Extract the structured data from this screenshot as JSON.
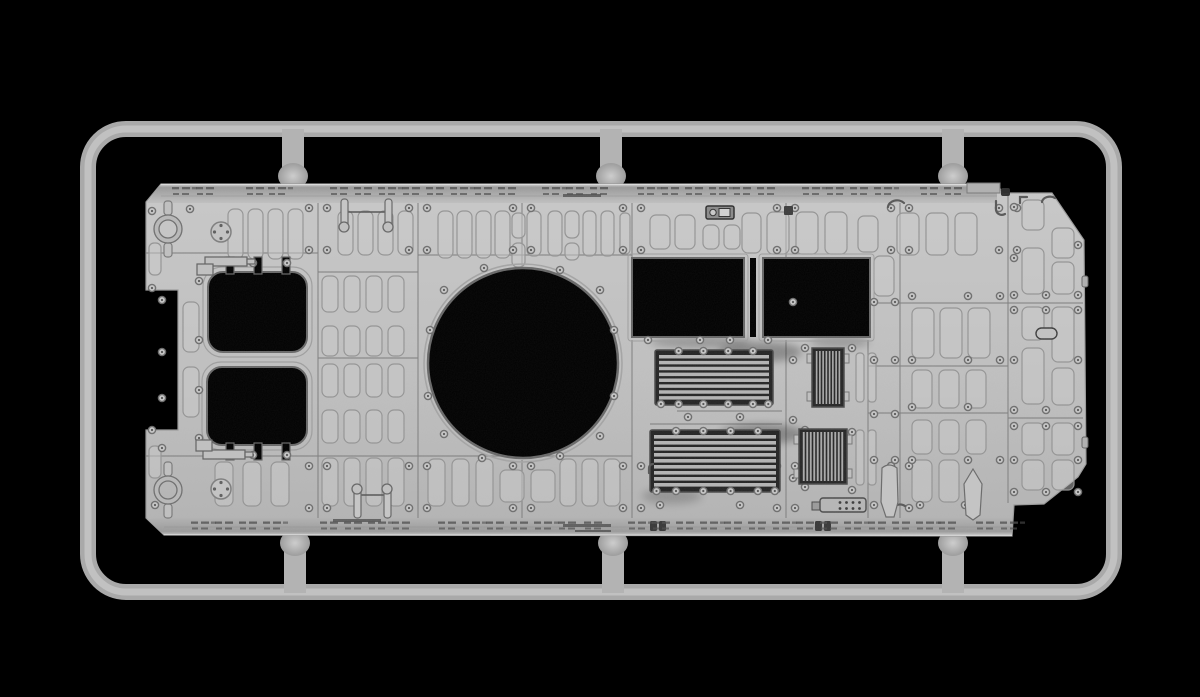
{
  "scene": {
    "description": "3D render of a gray injection-molded model kit sprue: armored vehicle upper hull roof part attached to a rounded rectangular runner frame on a black background",
    "width": 1200,
    "height": 697
  },
  "palette": {
    "background": "#000000",
    "runner": "#a9a9a9",
    "runner_core": "#c1c1c1",
    "gate": "#b3b3b3",
    "face_top": "#c8c8c8",
    "face_mid": "#bfbfbf",
    "face_bottom": "#b2b2b2",
    "strip_dark": "#9a9a9a",
    "strip_light": "#cfcfcf",
    "edge_highlight": "#dcdcdc",
    "outline": "#9a9a9a",
    "panel_line": "#7f7f7f",
    "pad_stroke": "#949494",
    "pad_fill": "#c9c9c9",
    "hole": "#000000",
    "hole_rim": "#686868",
    "rim_light": "#a4a4a4",
    "bolt_ring": "#6e6e6e",
    "bolt_fill": "#c6c6c6",
    "bolt_dot": "#565656",
    "grille_bg": "#242424",
    "grille_slat": "#b3b3b3",
    "detail_fill": "#c0c0c0",
    "detail_stroke": "#606060",
    "tick": "#4f4f4f",
    "dark_fitting": "#383838"
  },
  "sprue": {
    "frame": {
      "x": 88,
      "y": 129,
      "w": 1026,
      "h": 463,
      "rx": 38,
      "thickness": 16
    },
    "gates_top_x": [
      293,
      611,
      953
    ],
    "gates_bottom_x": [
      295,
      613,
      953
    ]
  },
  "part": {
    "outline": "M 161 184 L 997 184 L 1003 193 L 1052 193 L 1084 240 L 1086 464 L 1078 477 L 1044 504 L 1014 505 L 1012 536 L 164 535 L 146 518 L 146 430 L 178 430 L 178 290 L 146 290 L 146 202 Z",
    "strip_top": "M 161 184 L 997 184 L 997 203 L 147 203 Z",
    "strip_bottom": "M 156 518 L 1012 518 L 1012 536 L 164 535 L 147 519 Z",
    "turret_ring": {
      "cx": 523,
      "cy": 363,
      "r": 95
    },
    "hatches": [
      {
        "x": 208,
        "y": 272,
        "w": 99,
        "h": 80,
        "r": 15,
        "notch_side": "top",
        "notch_xs": [
          226,
          254,
          282
        ]
      },
      {
        "x": 207,
        "y": 367,
        "w": 100,
        "h": 78,
        "r": 15,
        "notch_side": "bottom",
        "notch_xs": [
          226,
          254,
          282
        ]
      }
    ],
    "rect_openings": [
      {
        "x": 632,
        "y": 258,
        "w": 112,
        "h": 79
      },
      {
        "x": 763,
        "y": 258,
        "w": 107,
        "h": 79
      }
    ],
    "bridge_slit": {
      "x": 750,
      "y": 258,
      "w": 6,
      "h": 79
    },
    "louver_grilles": [
      {
        "x": 655,
        "y": 350,
        "w": 118,
        "h": 55,
        "slats": 8
      },
      {
        "x": 650,
        "y": 430,
        "w": 130,
        "h": 62,
        "slats": 9
      }
    ],
    "slat_grilles": [
      {
        "x": 812,
        "y": 348,
        "w": 32,
        "h": 59,
        "slats": 8
      },
      {
        "x": 799,
        "y": 429,
        "w": 48,
        "h": 55,
        "slats": 12
      }
    ],
    "panel_lines_v": [
      [
        318,
        203,
        318,
        518
      ],
      [
        418,
        203,
        418,
        518
      ],
      [
        522,
        203,
        522,
        266
      ],
      [
        522,
        460,
        522,
        518
      ],
      [
        632,
        203,
        632,
        258
      ],
      [
        632,
        340,
        632,
        518
      ],
      [
        786,
        203,
        786,
        258
      ],
      [
        786,
        340,
        786,
        518
      ],
      [
        868,
        340,
        868,
        518
      ],
      [
        900,
        203,
        900,
        518
      ],
      [
        1008,
        193,
        1008,
        503
      ]
    ],
    "panel_lines_h": [
      [
        146,
        253,
        318,
        253
      ],
      [
        418,
        255,
        632,
        255
      ],
      [
        318,
        272,
        418,
        272
      ],
      [
        318,
        358,
        418,
        358
      ],
      [
        146,
        456,
        632,
        456
      ],
      [
        868,
        303,
        1083,
        303
      ],
      [
        868,
        366,
        1008,
        366
      ],
      [
        868,
        413,
        1008,
        413
      ],
      [
        1008,
        418,
        1083,
        418
      ],
      [
        677,
        411,
        782,
        411
      ],
      [
        650,
        424,
        782,
        424
      ]
    ],
    "pads": [
      {
        "x": 228,
        "y": 209,
        "w": 15,
        "h": 50,
        "n": 4,
        "g": 5
      },
      {
        "x": 149,
        "y": 243,
        "w": 12,
        "h": 32,
        "n": 1,
        "g": 0
      },
      {
        "x": 338,
        "y": 211,
        "w": 15,
        "h": 44,
        "n": 4,
        "g": 5
      },
      {
        "x": 438,
        "y": 211,
        "w": 15,
        "h": 47,
        "n": 4,
        "g": 4
      },
      {
        "x": 512,
        "y": 213,
        "w": 13,
        "h": 25,
        "n": 1,
        "g": 0
      },
      {
        "x": 512,
        "y": 243,
        "w": 13,
        "h": 24,
        "n": 1,
        "g": 0
      },
      {
        "x": 527,
        "y": 211,
        "w": 14,
        "h": 45,
        "n": 2,
        "g": 7
      },
      {
        "x": 565,
        "y": 211,
        "w": 14,
        "h": 27,
        "n": 1,
        "g": 0
      },
      {
        "x": 565,
        "y": 243,
        "w": 14,
        "h": 17,
        "n": 1,
        "g": 0
      },
      {
        "x": 583,
        "y": 211,
        "w": 13,
        "h": 45,
        "n": 2,
        "g": 5
      },
      {
        "x": 620,
        "y": 213,
        "w": 10,
        "h": 41,
        "n": 1,
        "g": 0
      },
      {
        "x": 650,
        "y": 215,
        "w": 20,
        "h": 34,
        "n": 2,
        "g": 5
      },
      {
        "x": 703,
        "y": 225,
        "w": 16,
        "h": 24,
        "n": 2,
        "g": 5
      },
      {
        "x": 742,
        "y": 213,
        "w": 19,
        "h": 40,
        "n": 1,
        "g": 0
      },
      {
        "x": 767,
        "y": 212,
        "w": 22,
        "h": 42,
        "n": 3,
        "g": 7
      },
      {
        "x": 858,
        "y": 216,
        "w": 20,
        "h": 36,
        "n": 1,
        "g": 0
      },
      {
        "x": 897,
        "y": 213,
        "w": 22,
        "h": 42,
        "n": 3,
        "g": 7
      },
      {
        "x": 322,
        "y": 276,
        "w": 16,
        "h": 36,
        "n": 4,
        "g": 6
      },
      {
        "x": 322,
        "y": 326,
        "w": 16,
        "h": 30,
        "n": 4,
        "g": 6
      },
      {
        "x": 322,
        "y": 364,
        "w": 16,
        "h": 33,
        "n": 4,
        "g": 6
      },
      {
        "x": 322,
        "y": 410,
        "w": 16,
        "h": 33,
        "n": 4,
        "g": 6
      },
      {
        "x": 322,
        "y": 458,
        "w": 16,
        "h": 48,
        "n": 4,
        "g": 6
      },
      {
        "x": 183,
        "y": 302,
        "w": 16,
        "h": 50,
        "n": 1,
        "g": 0
      },
      {
        "x": 183,
        "y": 367,
        "w": 16,
        "h": 50,
        "n": 1,
        "g": 0
      },
      {
        "x": 149,
        "y": 446,
        "w": 12,
        "h": 32,
        "n": 1,
        "g": 0
      },
      {
        "x": 215,
        "y": 462,
        "w": 18,
        "h": 44,
        "n": 3,
        "g": 10
      },
      {
        "x": 428,
        "y": 459,
        "w": 17,
        "h": 47,
        "n": 3,
        "g": 7
      },
      {
        "x": 500,
        "y": 470,
        "w": 24,
        "h": 32,
        "n": 2,
        "g": 7
      },
      {
        "x": 560,
        "y": 459,
        "w": 16,
        "h": 47,
        "n": 3,
        "g": 6
      },
      {
        "x": 856,
        "y": 353,
        "w": 8,
        "h": 49,
        "n": 2,
        "g": 4
      },
      {
        "x": 856,
        "y": 430,
        "w": 8,
        "h": 55,
        "n": 2,
        "g": 4
      },
      {
        "x": 912,
        "y": 308,
        "w": 22,
        "h": 50,
        "n": 3,
        "g": 6
      },
      {
        "x": 912,
        "y": 370,
        "w": 20,
        "h": 38,
        "n": 3,
        "g": 7
      },
      {
        "x": 912,
        "y": 420,
        "w": 20,
        "h": 34,
        "n": 3,
        "g": 7
      },
      {
        "x": 912,
        "y": 460,
        "w": 20,
        "h": 42,
        "n": 2,
        "g": 7
      },
      {
        "x": 874,
        "y": 256,
        "w": 20,
        "h": 40,
        "n": 1,
        "g": 0
      },
      {
        "x": 1022,
        "y": 200,
        "w": 22,
        "h": 30,
        "n": 1,
        "g": 0
      },
      {
        "x": 1022,
        "y": 248,
        "w": 22,
        "h": 46,
        "n": 1,
        "g": 0
      },
      {
        "x": 1052,
        "y": 228,
        "w": 22,
        "h": 30,
        "n": 1,
        "g": 0
      },
      {
        "x": 1052,
        "y": 262,
        "w": 22,
        "h": 32,
        "n": 1,
        "g": 0
      },
      {
        "x": 1022,
        "y": 307,
        "w": 22,
        "h": 33,
        "n": 1,
        "g": 0
      },
      {
        "x": 1052,
        "y": 307,
        "w": 22,
        "h": 55,
        "n": 1,
        "g": 0
      },
      {
        "x": 1022,
        "y": 348,
        "w": 22,
        "h": 56,
        "n": 1,
        "g": 0
      },
      {
        "x": 1052,
        "y": 368,
        "w": 22,
        "h": 37,
        "n": 1,
        "g": 0
      },
      {
        "x": 1022,
        "y": 423,
        "w": 22,
        "h": 32,
        "n": 2,
        "g": 8
      },
      {
        "x": 1022,
        "y": 460,
        "w": 22,
        "h": 30,
        "n": 2,
        "g": 8
      }
    ],
    "bolt_flank_vlines_top": [
      318,
      418,
      522,
      632,
      786,
      900,
      1008
    ],
    "bolt_flank_ys_top": [
      208,
      250
    ],
    "bolt_flank_vlines_bottom": [
      318,
      418,
      522,
      632,
      786,
      900
    ],
    "bolt_flank_ys_bottom": [
      466,
      508
    ],
    "bolts_extra": [
      [
        152,
        211
      ],
      [
        190,
        209
      ],
      [
        152,
        288
      ],
      [
        162,
        300
      ],
      [
        162,
        352
      ],
      [
        162,
        398
      ],
      [
        152,
        430
      ],
      [
        162,
        448
      ],
      [
        155,
        505
      ],
      [
        199,
        281
      ],
      [
        199,
        340
      ],
      [
        199,
        390
      ],
      [
        199,
        438
      ],
      [
        253,
        263
      ],
      [
        287,
        263
      ],
      [
        253,
        455
      ],
      [
        287,
        455
      ],
      [
        600,
        290
      ],
      [
        560,
        270
      ],
      [
        484,
        268
      ],
      [
        444,
        290
      ],
      [
        430,
        330
      ],
      [
        428,
        396
      ],
      [
        444,
        434
      ],
      [
        482,
        458
      ],
      [
        560,
        456
      ],
      [
        600,
        436
      ],
      [
        614,
        330
      ],
      [
        614,
        396
      ],
      [
        688,
        417
      ],
      [
        740,
        417
      ],
      [
        793,
        302
      ],
      [
        793,
        360
      ],
      [
        793,
        420
      ],
      [
        793,
        478
      ],
      [
        805,
        348
      ],
      [
        805,
        430
      ],
      [
        805,
        487
      ],
      [
        852,
        348
      ],
      [
        852,
        432
      ],
      [
        852,
        490
      ],
      [
        874,
        302
      ],
      [
        895,
        302
      ],
      [
        874,
        360
      ],
      [
        895,
        360
      ],
      [
        874,
        414
      ],
      [
        895,
        414
      ],
      [
        874,
        460
      ],
      [
        895,
        460
      ],
      [
        874,
        505
      ],
      [
        912,
        296
      ],
      [
        968,
        296
      ],
      [
        1000,
        296
      ],
      [
        912,
        360
      ],
      [
        968,
        360
      ],
      [
        1000,
        360
      ],
      [
        912,
        407
      ],
      [
        968,
        407
      ],
      [
        912,
        460
      ],
      [
        968,
        460
      ],
      [
        1000,
        460
      ],
      [
        920,
        505
      ],
      [
        965,
        505
      ],
      [
        1014,
        207
      ],
      [
        1014,
        258
      ],
      [
        1078,
        245
      ],
      [
        1014,
        295
      ],
      [
        1046,
        295
      ],
      [
        1078,
        295
      ],
      [
        1014,
        310
      ],
      [
        1046,
        310
      ],
      [
        1078,
        310
      ],
      [
        1014,
        360
      ],
      [
        1078,
        360
      ],
      [
        1014,
        410
      ],
      [
        1046,
        410
      ],
      [
        1078,
        410
      ],
      [
        1014,
        426
      ],
      [
        1046,
        426
      ],
      [
        1078,
        426
      ],
      [
        1014,
        460
      ],
      [
        1078,
        460
      ],
      [
        1014,
        492
      ],
      [
        1046,
        492
      ],
      [
        1078,
        492
      ],
      [
        660,
        505
      ],
      [
        740,
        505
      ],
      [
        648,
        340
      ],
      [
        700,
        340
      ],
      [
        730,
        340
      ],
      [
        768,
        340
      ]
    ],
    "tow_rings": [
      {
        "cx": 168,
        "cy": 229
      },
      {
        "cx": 168,
        "cy": 490
      }
    ],
    "caps": [
      {
        "cx": 221,
        "cy": 232
      },
      {
        "cx": 221,
        "cy": 489
      }
    ],
    "periscope_brackets": [
      [
        [
          205,
          257,
          42,
          9
        ],
        [
          197,
          264,
          16,
          11
        ],
        [
          247,
          259,
          8,
          5
        ]
      ],
      [
        [
          203,
          450,
          42,
          9
        ],
        [
          196,
          440,
          16,
          11
        ],
        [
          245,
          452,
          8,
          5
        ]
      ]
    ],
    "hinge_brackets": [
      {
        "rods": [
          [
            341,
            199,
            7,
            32
          ],
          [
            385,
            199,
            7,
            32
          ]
        ],
        "balls": [
          [
            344,
            227
          ],
          [
            388,
            227
          ]
        ],
        "bar": [
          344,
          212,
          388,
          212
        ]
      },
      {
        "rods": [
          [
            354,
            486,
            7,
            32
          ],
          [
            384,
            486,
            7,
            32
          ]
        ],
        "balls": [
          [
            357,
            489
          ],
          [
            387,
            489
          ]
        ],
        "bar": [
          357,
          495,
          387,
          495
        ]
      }
    ],
    "hooks": [
      "M888 207 a9 7 0 0 1 16 -4",
      "M996 201 l0 9 a6 6 0 0 0 9 4",
      "M1020 203 l0 -6 l7 0",
      "M1042 202 a8 6 0 0 1 13 -4",
      "M649 473 l0 -5 a4 4 0 0 1 4 -4",
      "M893 509 a7 5 0 0 1 12 -3"
    ],
    "raised_block": [
      967,
      183,
      33,
      10
    ],
    "dark_knob": [
      1001,
      188,
      9,
      8
    ],
    "dark_clip": [
      784,
      206,
      9,
      9
    ],
    "latch_plate": {
      "box": [
        706,
        206,
        28,
        13
      ],
      "dial": [
        713,
        212.5,
        3.2
      ],
      "window": [
        719,
        208.5,
        11,
        8
      ]
    },
    "handle": [
      1036,
      328,
      21,
      11
    ],
    "edge_nubs": [
      [
        1082,
        276,
        6,
        11
      ],
      [
        1082,
        437,
        6,
        11
      ]
    ],
    "tools": [
      "M882 468 q7 -6 15 0 l1 34 l-4 15 l-8 0 l-5 -15 Z",
      "M973 469 l9 15 l-2 31 l-7 5 l-7 -5 l-2 -31 Z"
    ],
    "keypad": {
      "box": [
        820,
        498,
        46,
        14
      ],
      "tab": [
        812,
        502,
        8,
        8
      ],
      "dot_x0": 840,
      "dot_dx": 6.5,
      "dot_n": 4,
      "dot_ys": [
        502.5,
        508.5
      ]
    },
    "strip_rods": [
      [
        563,
        194,
        38,
        3
      ],
      [
        563,
        524,
        48,
        3
      ],
      [
        575,
        530,
        36,
        2
      ],
      [
        333,
        519,
        48,
        3
      ]
    ],
    "dark_pills": [
      [
        650,
        521,
        7,
        10
      ],
      [
        659,
        521,
        7,
        10
      ],
      [
        815,
        521,
        7,
        10
      ],
      [
        824,
        521,
        7,
        10
      ]
    ],
    "ticks_top": {
      "y": 187,
      "xs": [
        172,
        196,
        246,
        268,
        330,
        354,
        378,
        402,
        426,
        450,
        474,
        498,
        542,
        566,
        590,
        637,
        661,
        685,
        709,
        733,
        757,
        802,
        826,
        850,
        874,
        920,
        944
      ]
    },
    "ticks_bottom": {
      "y": 521.5,
      "xs": [
        191,
        215,
        239,
        263,
        320,
        344,
        368,
        392,
        438,
        462,
        486,
        510,
        534,
        558,
        584,
        628,
        652,
        676,
        700,
        724,
        748,
        772,
        796,
        820,
        844,
        868,
        892,
        916,
        938,
        976,
        1000
      ]
    },
    "ao_shadows": [
      [
        760,
        352,
        42,
        10,
        0.28
      ],
      [
        762,
        434,
        42,
        10,
        0.28
      ],
      [
        672,
        496,
        30,
        8,
        0.18
      ],
      [
        700,
        342,
        50,
        6,
        0.22
      ],
      [
        840,
        342,
        30,
        6,
        0.2
      ]
    ]
  }
}
